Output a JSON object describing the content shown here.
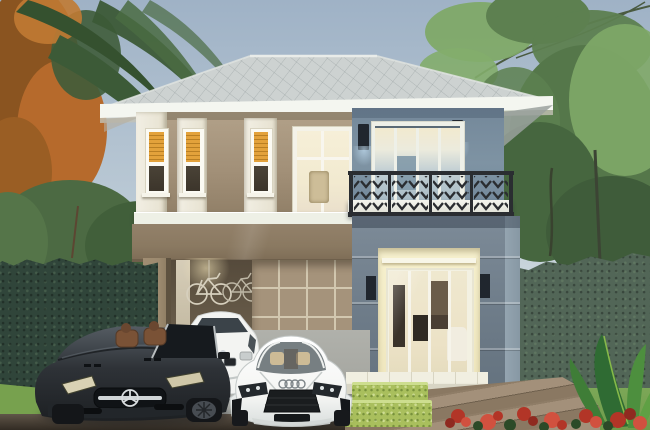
{
  "scene": {
    "type": "architectural-3d-render",
    "description": "Two-story modern tropical house with gray hip roof, tan and blue-gray facade, lit narrow windows, balcony with dark chevron railing, carport with two bicycles on the wall, dark Mercedes convertible, white sedan and white Audi R8 parked in front, dark hedges, palm fronds and an orange autumn tree on the left, green trees on the right, wooden deck, trimmed hedge boxes and red flowers in the foreground",
    "elements": {
      "sky": "overcast blue-gray sky",
      "roof": "gray shingle hip roof with white fascia",
      "upper_left_wall": "tan wall with lit narrow windows",
      "upper_right_wall": "blue-gray wall with glass doors and balcony",
      "carport": "carport with taupe beam, pillar, tiled wall and two wall-hung bicycles",
      "entry": "recessed warm-lit entry with glass sliding doors",
      "cars": [
        "dark convertible",
        "white sedan",
        "white sports car"
      ],
      "landscape": [
        "left dark hedge",
        "right hedge",
        "palm fronds",
        "autumn tree",
        "green trees",
        "wood deck",
        "hedge boxes",
        "red flowers",
        "foliage plant"
      ]
    }
  },
  "colors": {
    "sky_top": "#9fb2c6",
    "sky_mid": "#b9c8d4",
    "sky_low": "#cfd9de",
    "roof": "#cdd2d1",
    "roof_hatch": "#8e9899",
    "fascia": "#f4f6f0",
    "wall_tan_light": "#b2a189",
    "wall_tan": "#a18f77",
    "wall_tan_dark": "#8d7c64",
    "beam": "#8a7961",
    "beam_dark": "#6e5f4b",
    "trim": "#f2efe4",
    "trim_shade": "#d9d4c2",
    "window_amber": "#e3a23b",
    "glass_dark": "#3c352b",
    "upper_blue": "#7e93a3",
    "lower_blue": "#6d7b88",
    "blue_face": "#94a4b0",
    "interior_cream": "#f6eecd",
    "pane_blue": "#a8bbc5",
    "railing": "#2a2d31",
    "sconce": "#20262e",
    "carport_interior": "#675b49",
    "carport_pillar": "#9c8a6f",
    "tile_wall": "#a5937b",
    "tile_line": "#d2c7af",
    "hedge_left": "#30453a",
    "hedge_right": "#526657",
    "tree_dark": "#3f5c3a",
    "tree_mid": "#5d8050",
    "tree_light": "#7fa968",
    "autumn": "#b66a2c",
    "autumn_dark": "#8a5420",
    "palm": "#3c5a37",
    "driveway": "#a7a9a5",
    "driveway_dark": "#8b8e8a",
    "deck": "#9b8872",
    "deck_line": "#6f604d",
    "grass": "#77a14e",
    "lawn": "#6f9b4b",
    "box_green": "#a9bf5d",
    "box_green_light": "#cdde8f",
    "flower": "#b23527",
    "flower_light": "#d1513f",
    "flower_leaf": "#2c4a28",
    "shadow_band": "#55483a",
    "car_dark": "#2e3237",
    "car_dark_hi": "#555c63",
    "seat_brown": "#7a5236",
    "chrome": "#cfd4d6",
    "car_white": "#f3f4f2",
    "step": "#f1efe1",
    "step_face": "#d8d5c5"
  }
}
